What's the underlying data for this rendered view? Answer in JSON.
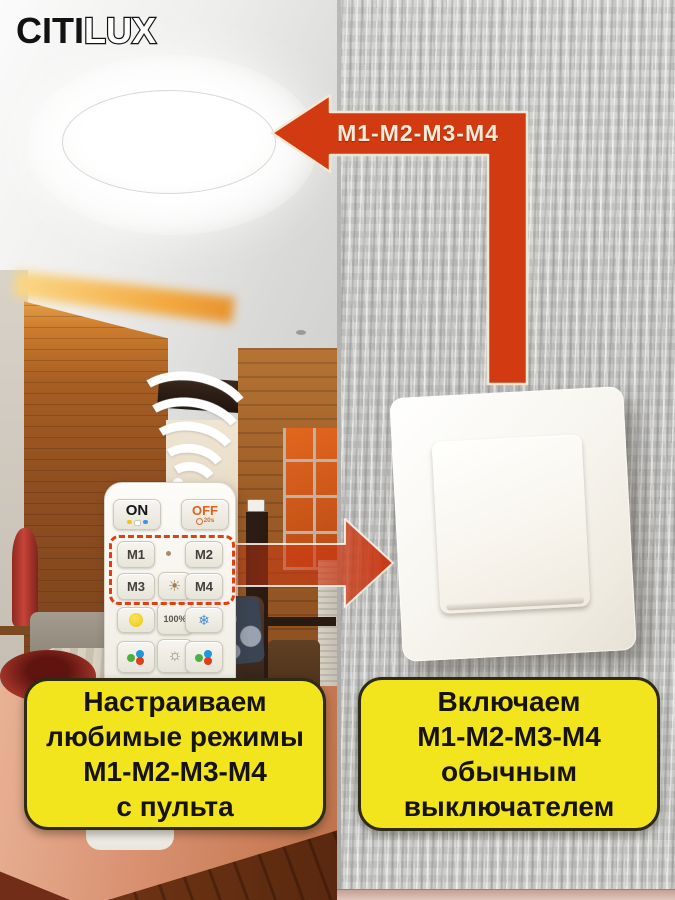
{
  "brand": {
    "name_solid": "CITI",
    "name_outline": "LUX"
  },
  "colors": {
    "arrow_red": "#d23b12",
    "arrow_text": "#f6ecd8",
    "callout_yellow": "#f2e41d",
    "callout_border": "#2f2a16",
    "off_orange": "#e2611c",
    "wall_gray": "#c7c7c5"
  },
  "top_arrow": {
    "label": "M1-M2-M3-M4"
  },
  "remote": {
    "power_on": "ON",
    "power_off": "OFF",
    "off_timer": "20s",
    "mode_buttons": [
      "M1",
      "M2",
      "M3",
      "M4"
    ],
    "brightness_label": "100%",
    "cold_icon_glyph": "❄",
    "sun_icon_glyph": "☀",
    "night_icon_glyph": "☼"
  },
  "callouts": {
    "left": {
      "lines": [
        "Настраиваем",
        "любимые режимы",
        "М1-М2-М3-М4",
        "с пульта"
      ]
    },
    "right": {
      "lines": [
        "Включаем",
        "М1-М2-М3-М4",
        "обычным",
        "выключателем"
      ]
    }
  }
}
